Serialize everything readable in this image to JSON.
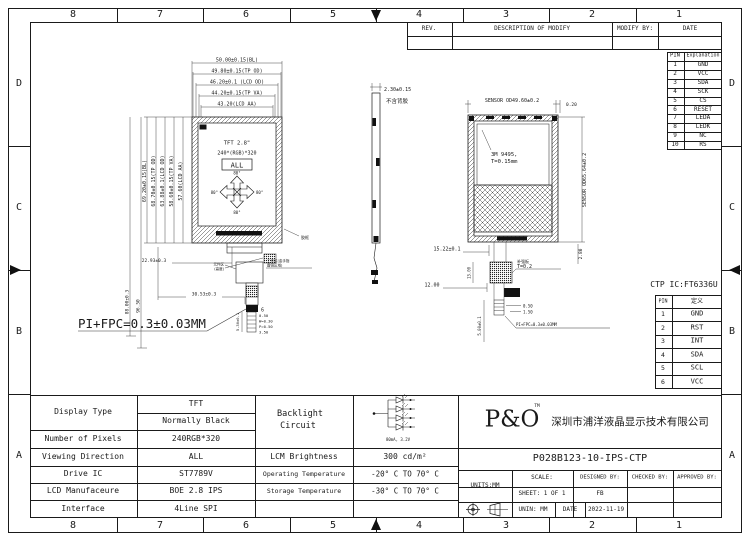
{
  "frame": {
    "cols": [
      "8",
      "7",
      "6",
      "5",
      "4",
      "3",
      "2",
      "1"
    ],
    "rows": [
      "D",
      "C",
      "B",
      "A"
    ]
  },
  "rev": {
    "rev": "REV.",
    "desc": "DESCRIPTION OF MODIFY",
    "by": "MODIFY BY:",
    "date": "DATE"
  },
  "pin_table": {
    "h1": "PIN",
    "h2": "Explanation",
    "pins": [
      "1",
      "2",
      "3",
      "4",
      "5",
      "6",
      "7",
      "8",
      "9",
      "10"
    ],
    "names": [
      "GND",
      "VCC",
      "SDA",
      "SCK",
      "CS",
      "RESET",
      "LEDA",
      "LEDK",
      "NC",
      "RS"
    ]
  },
  "ctp": {
    "title": "CTP IC:FT6336U",
    "h1": "PIN",
    "h2": "定义",
    "pins": [
      "1",
      "2",
      "3",
      "4",
      "5",
      "6"
    ],
    "names": [
      "GND",
      "RST",
      "INT",
      "SDA",
      "SCL",
      "VCC"
    ]
  },
  "front": {
    "dims_top": [
      "50.00±0.15(BL)",
      "49.80±0.15(TP OD)",
      "46.20±0.1 (LCD OD)",
      "44.20±0.15(TP VA)",
      "43.20(LCD AA)"
    ],
    "dims_left": [
      "69.20±0.15(BL)",
      "68.70±0.15(TP OD)",
      "63.88±0.1(LCD OD)",
      "58.60±0.15(TP VA)",
      "57.60(LCD AA)"
    ],
    "dim_total1": "88.00±0.3",
    "dim_total2": "96.50",
    "dim_a": "22.93±0.3",
    "dim_b": "30.53±0.3",
    "title": "TFT 2.8\"",
    "res": "240*(RGB)*320",
    "all": "ALL",
    "ang_t": "80°",
    "ang_b": "80°",
    "ang_l": "80°",
    "ang_r": "80°",
    "frame_label": "胶框",
    "comp_label1": "元件区",
    "comp_label2": "(高度)",
    "work_label1": "工作区(金手指",
    "work_label2": "露铜区域)",
    "pin_count": "6",
    "comb": [
      "0.50",
      "W=0.30",
      "P=0.50",
      "3.50"
    ],
    "comb_len": "5.30±0.1",
    "note": "PI+FPC=0.3±0.03MM"
  },
  "side": {
    "dim": "2.30±0.15",
    "note": "不含背胶"
  },
  "back": {
    "dim_top": "SENSOR OD49.60±0.2",
    "dim_gap": "0.20",
    "dim_right": "SENSOR OD65.64±0.2",
    "tape1": "3M 9495,",
    "tape2": "T=0.15mm",
    "dim_off": "15.22±0.1",
    "dim_h": "2.80",
    "dim_stiff_h": "13.00",
    "dim_stiff_w": "12.00",
    "stiff_cn": "补强板",
    "stiff_t": "T=0.2",
    "d050": "0.50",
    "d150": "1.50",
    "d500": "5.00±0.1",
    "note": "PI+FPC=0.3±0.03MM"
  },
  "spec": {
    "display_type": "Display Type",
    "display_v1": "TFT",
    "display_v2": "Normally Black",
    "pixels_l": "Number of Pixels",
    "pixels_v": "240RGB*320",
    "view_l": "Viewing Direction",
    "view_v": "ALL",
    "ic_l": "Drive IC",
    "ic_v": "ST7789V",
    "mfg_l": "LCD Manufaceure",
    "mfg_v": "BOE 2.8 IPS",
    "if_l": "Interface",
    "if_v": "4Line SPI",
    "bl1": "Backlight",
    "bl2": "Circuit",
    "bl_note": "80mA, 3.2V",
    "bright_l": "LCM Brightness",
    "bright_v": "300 cd/m²",
    "op_l": "Operating Temperature",
    "op_v": "-20° C TO 70° C",
    "st_l": "Storage Temperature",
    "st_v": "-30° C TO 70° C"
  },
  "title_block": {
    "logo": "P&O",
    "tm": "TM",
    "company": "深圳市浦洋液晶显示技术有限公司",
    "pn": "P028B123-10-IPS-CTP",
    "units": "UNITS:MM",
    "scale": "SCALE:",
    "designed": "DESIGNED BY:",
    "checked": "CHECKED BY:",
    "approved": "APPROVED BY:",
    "sheet": "SHEET: 1 OF 1",
    "designer": "FB",
    "unin": "UNIN: MM",
    "date_l": "DATE",
    "date_v": "2022-11-19"
  }
}
